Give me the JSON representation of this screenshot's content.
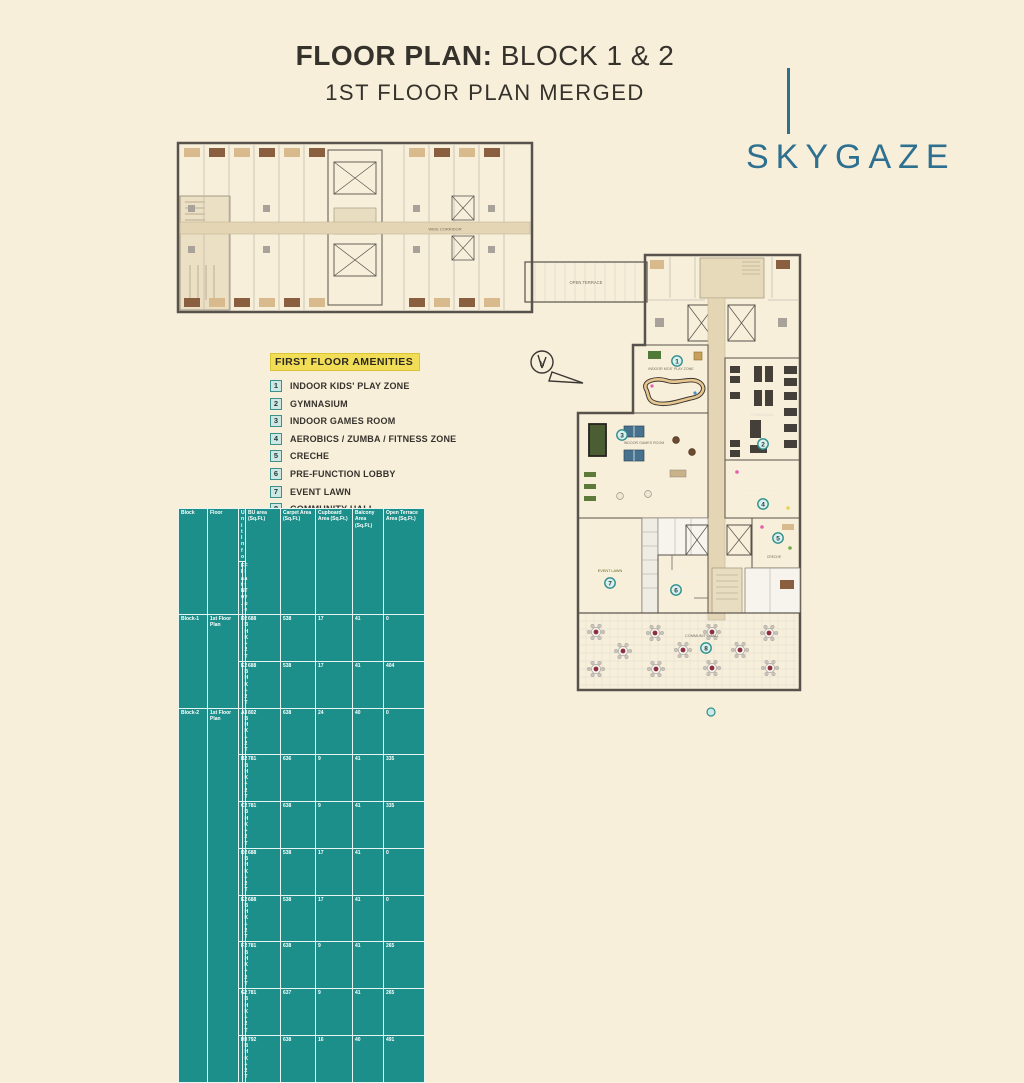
{
  "header": {
    "title_bold": "FLOOR PLAN:",
    "title_rest": " BLOCK 1 & 2",
    "subtitle": "1ST FLOOR PLAN MERGED"
  },
  "brand": {
    "name": "SKYGAZE",
    "color": "#2e7090"
  },
  "amenities": {
    "heading": "FIRST FLOOR AMENITIES",
    "items": [
      {
        "num": "1",
        "label": "INDOOR KIDS' PLAY ZONE"
      },
      {
        "num": "2",
        "label": "GYMNASIUM"
      },
      {
        "num": "3",
        "label": "INDOOR GAMES ROOM"
      },
      {
        "num": "4",
        "label": "AEROBICS / ZUMBA / FITNESS ZONE"
      },
      {
        "num": "5",
        "label": "CRECHE"
      },
      {
        "num": "6",
        "label": "PRE-FUNCTION LOBBY"
      },
      {
        "num": "7",
        "label": "EVENT LAWN"
      },
      {
        "num": "8",
        "label": "COMMUNITY HALL"
      }
    ]
  },
  "plan": {
    "compass": "N",
    "labels": {
      "terrace": "OPEN TERRACE",
      "corridor": "WIDE CORRIDOR",
      "kids": "INDOOR KIDS' PLAY ZONE",
      "gym": "GYMNASIUM",
      "games": "INDOOR GAMES ROOM",
      "aerobics": "AEROBICS / ZUMBA",
      "creche": "CRECHE",
      "lobby": "PRE-FUNCTION LOBBY",
      "lawn": "EVENT LAWN",
      "hall": "COMMUNITY HALL"
    }
  },
  "table": {
    "columns": [
      "Block",
      "Floor",
      "Unit Info",
      "BU area (Sq.Ft.)",
      "Carpet Area (Sq.Ft.)",
      "Cupboard Area (Sq.Ft.)",
      "Balcony Area (Sq.Ft.)",
      "Open Terrace Area (Sq.Ft.)"
    ],
    "unit_info_sub": [
      "Flat No.",
      "Flat Type"
    ],
    "groups": [
      {
        "block": "Block-1",
        "floor": "1st Floor Plan",
        "rows": [
          [
            "D",
            "2BHK+2 T",
            "688",
            "538",
            "17",
            "41",
            "0"
          ],
          [
            "E",
            "2BHK+2 T",
            "688",
            "538",
            "17",
            "41",
            "404"
          ]
        ]
      },
      {
        "block": "Block-2",
        "floor": "1st Floor Plan",
        "rows": [
          [
            "A",
            "3BHK+2 T",
            "802",
            "638",
            "24",
            "40",
            "0"
          ],
          [
            "B",
            "2BHK+2 T",
            "781",
            "636",
            "9",
            "41",
            "335"
          ],
          [
            "C",
            "2BHK+2 T",
            "781",
            "638",
            "9",
            "41",
            "335"
          ],
          [
            "D",
            "2BHK+2 T",
            "688",
            "538",
            "17",
            "41",
            "0"
          ],
          [
            "E",
            "2BHK+2 T",
            "688",
            "538",
            "17",
            "41",
            "0"
          ],
          [
            "F",
            "2BHK+2 T",
            "781",
            "638",
            "9",
            "41",
            "265"
          ],
          [
            "G",
            "2BHK+2 T",
            "781",
            "637",
            "9",
            "41",
            "265"
          ],
          [
            "H",
            "3BHK+2 T",
            "792",
            "638",
            "16",
            "40",
            "491"
          ]
        ]
      }
    ]
  },
  "colors": {
    "background": "#f8efdb",
    "brand_blue": "#2e7090",
    "table_teal": "#1d8f8a",
    "highlight_yellow": "#f2de56",
    "kids_tan": "#eed5a6",
    "games_orange": "#dd9c48",
    "aerobics_orange": "#cd7d3a",
    "gym_brown": "#7b5944",
    "lawn_green": "#9cb23c",
    "lobby_grey": "#9a968e",
    "hall_tile": "#e7e6e1",
    "hall_table_maroon": "#8e2f3e",
    "corridor_beige": "#e4d6b4",
    "wall_grey": "#57524b"
  }
}
